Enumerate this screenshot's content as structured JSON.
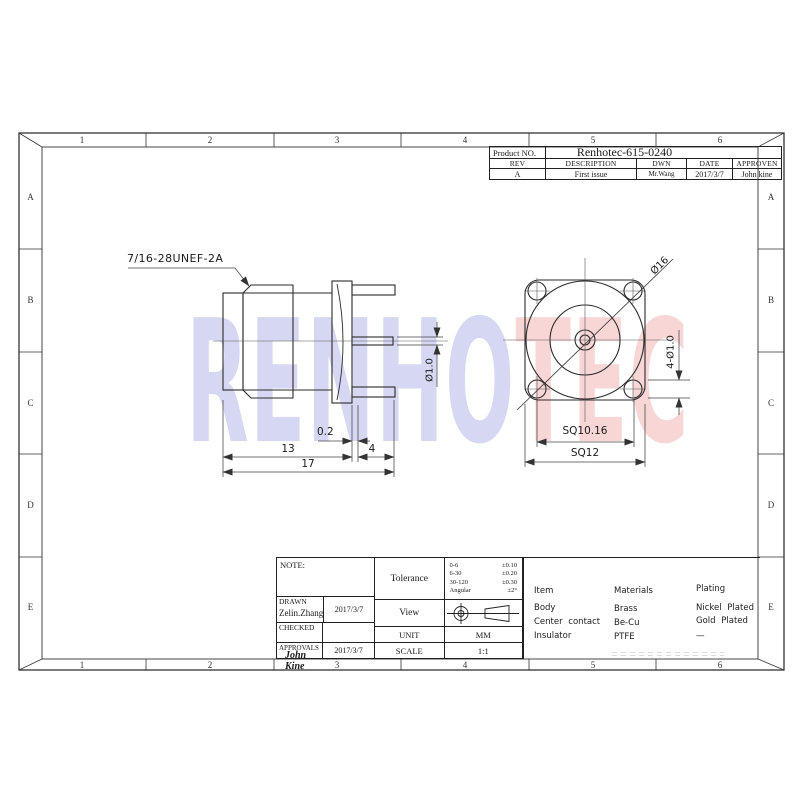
{
  "title_block": {
    "product_label": "Product NO.",
    "product_no": "Renhotec-615-0240",
    "headers": [
      "REV",
      "DESCRIPTION",
      "DWN",
      "DATE",
      "APPROVEN"
    ],
    "revision": {
      "rev": "A",
      "description": "First issue",
      "dwn": "Mr.Wang",
      "date": "2017/3/7",
      "approven": "John kine"
    }
  },
  "frame": {
    "top_zones": [
      "1",
      "2",
      "3",
      "4",
      "5",
      "6"
    ],
    "bottom_zones": [
      "1",
      "2",
      "3",
      "4",
      "5",
      "6"
    ],
    "left_rows": [
      "A",
      "B",
      "C",
      "D",
      "E"
    ],
    "right_rows": [
      "A",
      "B",
      "C",
      "D",
      "E"
    ]
  },
  "views": {
    "side": {
      "thread_label": "7/16-28UNEF-2A",
      "dim_gap": "0.2",
      "dim_body_len": "13",
      "dim_pin_len": "4",
      "dim_total_len": "17",
      "dim_pin_dia": "Ø1.0"
    },
    "front": {
      "dim_flange_dia": "Ø16",
      "dim_holes": "4-Ø1.0",
      "dim_hole_pitch": "SQ10.16",
      "dim_flange_sq": "SQ12"
    }
  },
  "info_block": {
    "note_label": "NOTE:",
    "drawn_label": "DRAWN",
    "drawn_name": "Zelin.Zhang",
    "drawn_date": "2017/3/7",
    "checked_label": "CHECKED",
    "approvals_label": "APPROVALS",
    "approvals_sign": "John Kine",
    "approvals_date": "2017/3/7",
    "tolerance_label": "Tolerance",
    "tolerance_rows": [
      {
        "range": "0-6",
        "tol": "±0.10"
      },
      {
        "range": "6-30",
        "tol": "±0.20"
      },
      {
        "range": "30-120",
        "tol": "±0.30"
      },
      {
        "range": "Angular",
        "tol": "±2°"
      }
    ],
    "view_label": "View",
    "unit_label": "UNIT",
    "unit_value": "MM",
    "scale_label": "SCALE",
    "scale_value": "1:1"
  },
  "materials_table": {
    "headers": [
      "Item",
      "Materials",
      "Plating"
    ],
    "rows": [
      [
        "Body",
        "Brass",
        "Nickel Plated"
      ],
      [
        "Center contact",
        "Be-Cu",
        "Gold Plated"
      ],
      [
        "Insulator",
        "PTFE",
        "—"
      ]
    ]
  },
  "watermark": {
    "part1": "RENHO",
    "part2": "TEC",
    "color1": "#d3d5f2",
    "color2": "#f8d3d3"
  }
}
